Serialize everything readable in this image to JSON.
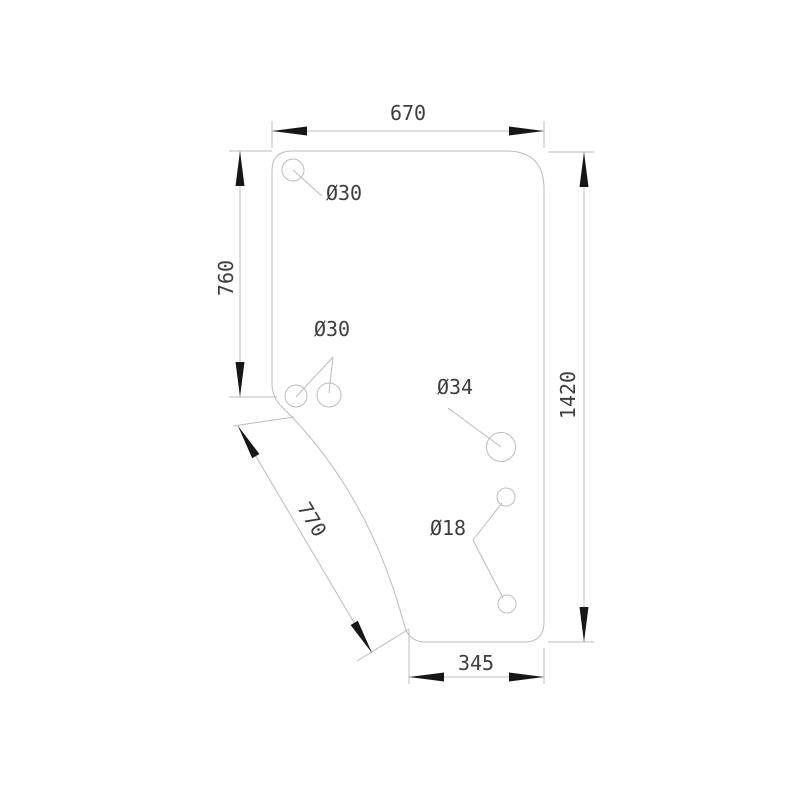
{
  "drawing": {
    "type": "technical-dimension-drawing",
    "subject": "glass-panel-outline-with-holes",
    "background": "#ffffff",
    "colors": {
      "line": "#bcbcbc",
      "arrowhead": "#161616",
      "text": "#3d3d3d"
    },
    "dims": {
      "top_width": "670",
      "left_height": "760",
      "right_height": "1420",
      "diagonal_edge": "770",
      "bottom_width": "345"
    },
    "holes": {
      "top_left": "Ø30",
      "mid_left_pair": "Ø30",
      "center_large": "Ø34",
      "right_small_pair": "Ø18"
    }
  }
}
